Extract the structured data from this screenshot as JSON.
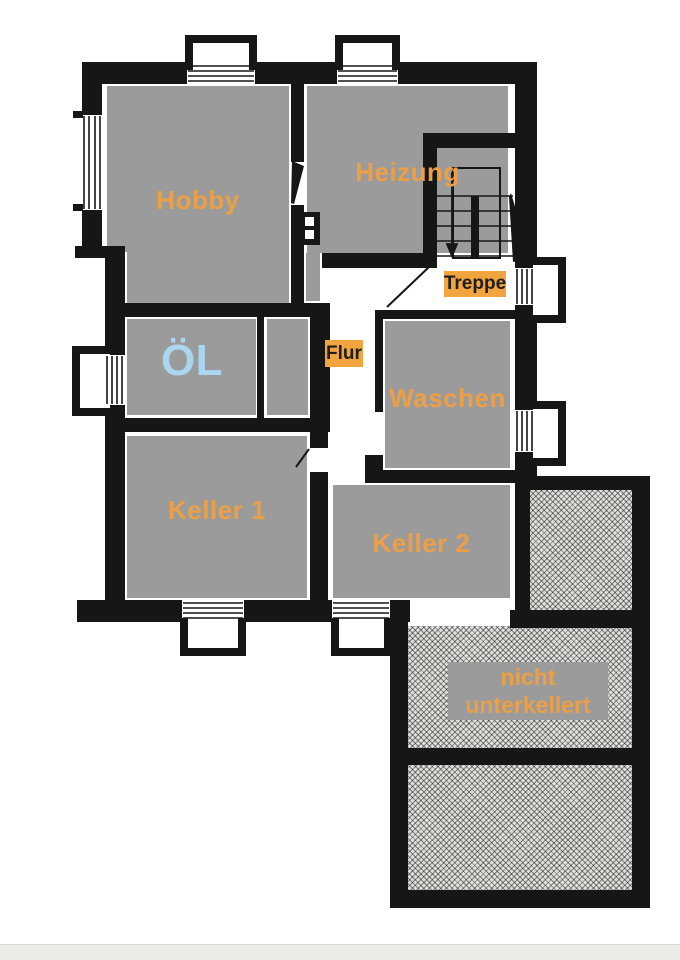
{
  "rooms": [
    {
      "id": "hobby",
      "label": "Hobby"
    },
    {
      "id": "heizung",
      "label": "Heizung"
    },
    {
      "id": "oel",
      "label": "ÖL"
    },
    {
      "id": "waschen",
      "label": "Waschen"
    },
    {
      "id": "keller-1",
      "label": "Keller 1"
    },
    {
      "id": "keller-2",
      "label": "Keller 2"
    }
  ],
  "labels": {
    "treppe": "Treppe",
    "flur": "Flur",
    "note": "nicht unterkellert"
  },
  "colors": {
    "label-orange": "#ec9f45",
    "oel-blue": "#a9d6f0",
    "room-gray": "#9b9b9b",
    "wall-black": "#161616",
    "tag-bg": "#f2a53e",
    "tag-text": "#1e1e1e",
    "hatch-base": "#dfdfdd",
    "footer-bar": "#ebebe9"
  }
}
